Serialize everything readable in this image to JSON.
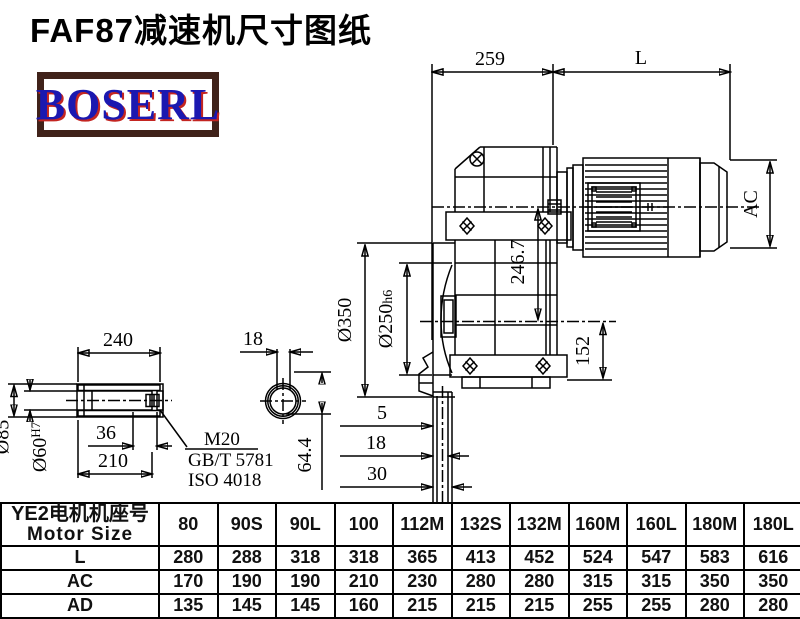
{
  "title": {
    "text": "FAF87减速机尺寸图纸"
  },
  "logo": {
    "text": "BOSERL"
  },
  "colors": {
    "line": "#000000",
    "logo_text": "#1b18b0",
    "logo_shadow": "#c42521",
    "logo_border": "#40221a"
  },
  "drawing": {
    "main": {
      "dim259": "259",
      "dimL": "L",
      "dimAC": "AC",
      "dim2467": "246.7",
      "d350": "Ø350",
      "d250": "Ø250",
      "d250sub": "h6",
      "dim152": "152",
      "dim5": "5",
      "dim18": "18",
      "dim30": "30"
    },
    "shaft": {
      "dim240": "240",
      "d85": "Ø85",
      "d60": "Ø60",
      "d60sup": "H7",
      "dim36": "36",
      "dim210": "210",
      "thread": "M20",
      "std1": "GB/T 5781",
      "std2": "ISO 4018"
    },
    "section": {
      "dim18": "18",
      "dim644": "64.4"
    }
  },
  "table": {
    "header": {
      "line1": "YE2电机机座号",
      "line2": "Motor Size"
    },
    "columns": [
      "80",
      "90S",
      "90L",
      "100",
      "112M",
      "132S",
      "132M",
      "160M",
      "160L",
      "180M",
      "180L"
    ],
    "rows": [
      {
        "label": "L",
        "values": [
          "280",
          "288",
          "318",
          "318",
          "365",
          "413",
          "452",
          "524",
          "547",
          "583",
          "616"
        ]
      },
      {
        "label": "AC",
        "values": [
          "170",
          "190",
          "190",
          "210",
          "230",
          "280",
          "280",
          "315",
          "315",
          "350",
          "350"
        ]
      },
      {
        "label": "AD",
        "values": [
          "135",
          "145",
          "145",
          "160",
          "215",
          "215",
          "215",
          "255",
          "255",
          "280",
          "280"
        ]
      }
    ]
  }
}
